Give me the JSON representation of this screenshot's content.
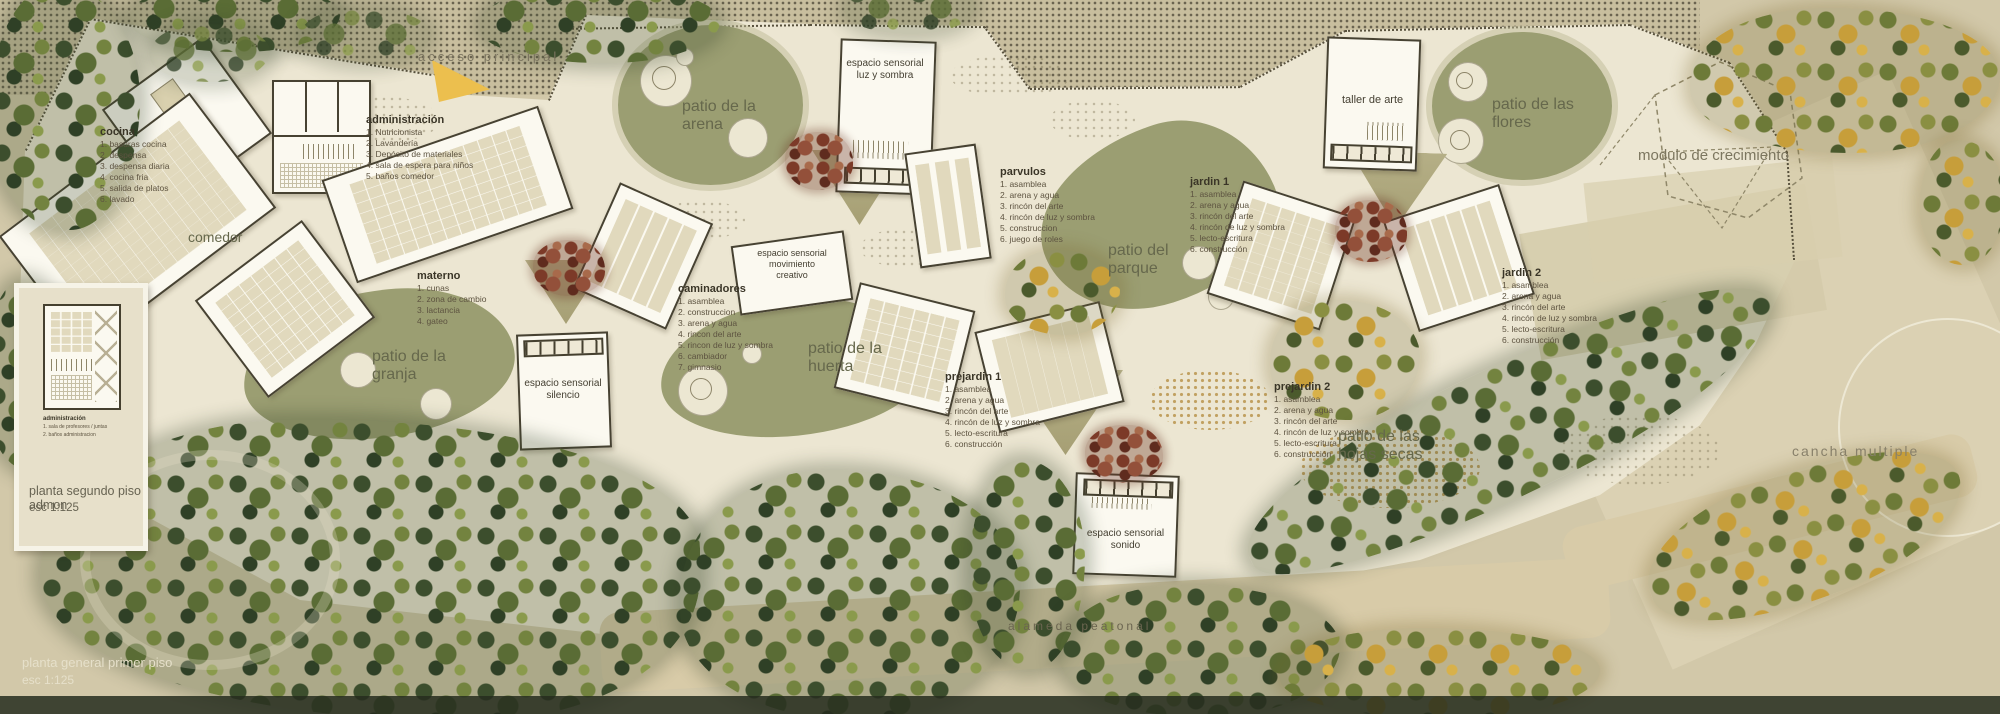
{
  "title_block": {
    "line1": "planta general primer piso",
    "line2": "esc 1:125"
  },
  "inset": {
    "caption_line1": "planta segundo piso admon",
    "caption_line2": "esc 1:125",
    "legend_title": "administración",
    "legend_items": [
      "1. sala de profesores / juntas",
      "2. baños administracion"
    ]
  },
  "site_labels": {
    "acceso_principal": "acceso principal",
    "alameda_peatonal": "alameda peatonal",
    "cancha_multiple": "cancha multiple",
    "modulo_crecimiento": "modulo de crecimiento",
    "comedor": "comedor",
    "taller_de_arte": "taller de arte",
    "patio_arena": "patio de la\narena",
    "patio_granja": "patio de la\ngranja",
    "patio_huerta": "patio de la\nhuerta",
    "patio_parque": "patio del\nparque",
    "patio_flores": "patio de las\nflores",
    "patio_hojas_secas": "patio de las\nhojas secas",
    "sens_luz_sombra": "espacio sensorial\nluz y sombra",
    "sens_mov_creativo": "espacio sensorial\nmovimiento\ncreativo",
    "sens_silencio": "espacio sensorial\nsilencio",
    "sens_sonido": "espacio sensorial\nsonido"
  },
  "legends": {
    "cocina": {
      "title": "cocina",
      "items": [
        "1. basuras cocina",
        "2. despensa",
        "3. despensa diaria",
        "4. cocina fria",
        "5. salida de platos",
        "6. lavado"
      ]
    },
    "administracion": {
      "title": "administración",
      "items": [
        "1. Nutricionista",
        "2. Lavandería",
        "3. Depósito de materiales",
        "4. sala de espera para niños",
        "5. baños comedor"
      ]
    },
    "materno": {
      "title": "materno",
      "items": [
        "1. cunas",
        "2. zona de cambio",
        "3. lactancia",
        "4. gateo"
      ]
    },
    "caminadores": {
      "title": "caminadores",
      "items": [
        "1. asamblea",
        "2. construccion",
        "3. arena y agua",
        "4. rincon del arte",
        "5. rincon de luz y sombra",
        "6. cambiador",
        "7. gimnasio"
      ]
    },
    "parvulos": {
      "title": "parvulos",
      "items": [
        "1. asamblea",
        "2. arena y agua",
        "3. rincón del arte",
        "4. rincón de luz y sombra",
        "5. construccion",
        "6. juego de roles"
      ]
    },
    "jardin1": {
      "title": "jardin 1",
      "items": [
        "1. asamblea",
        "2. arena y agua",
        "3. rincón del arte",
        "4. rincón de luz y sombra",
        "5. lecto-escritura",
        "6. construcción"
      ]
    },
    "jardin2": {
      "title": "jardin 2",
      "items": [
        "1. asamblea",
        "2. arena y agua",
        "3. rincón del arte",
        "4. rincón de luz y sombra",
        "5. lecto-escritura",
        "6. construcción"
      ]
    },
    "prejardin1": {
      "title": "prejardin 1",
      "items": [
        "1. asamblea",
        "2. arena y agua",
        "3. rincón del arte",
        "4. rincón de luz y sombra",
        "5. lecto-escritura",
        "6. construcción"
      ]
    },
    "prejardin2": {
      "title": "prejardin 2",
      "items": [
        "1. asamblea",
        "2. arena y agua",
        "3. rincón del arte",
        "4. rincón de luz y sombra",
        "5. lecto-escritura",
        "6. construcción"
      ]
    }
  },
  "colors": {
    "outer_ground": "#d2c8a9",
    "inner_ground": "#ece6d2",
    "patio_green": "#9b9e72",
    "courtyard_khaki": "#b0aa80",
    "wall_dark": "#474232",
    "building_fill": "#fbf9f0",
    "access_arrow_yellow": "#ecbf4e",
    "tree_green_dark": "#3c4e2d",
    "tree_autumn_yellow": "#c79e3a",
    "tree_red": "#7c3a28",
    "label_ink": "#66684c"
  }
}
